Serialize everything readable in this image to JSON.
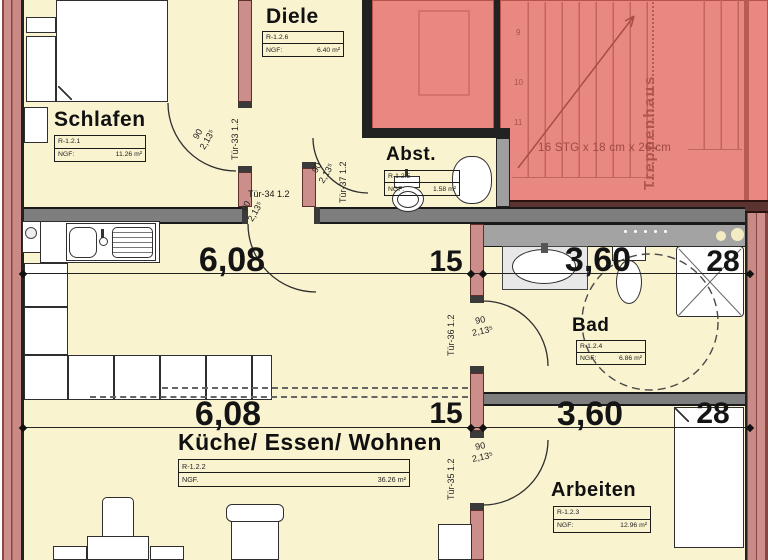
{
  "plan": {
    "rooms": {
      "schlafen": {
        "name": "Schlafen",
        "id": "R-1.2.1",
        "ngf": "NGF:",
        "area": "11.26 m²"
      },
      "diele": {
        "name": "Diele",
        "id": "R-1.2.6",
        "ngf": "NGF:",
        "area": "6.40 m²"
      },
      "abst": {
        "name": "Abst.",
        "id": "R-1.2.5",
        "ngf": "NGF:",
        "area": "1.58 m²"
      },
      "bad": {
        "name": "Bad",
        "id": "R-1.2.4",
        "ngf": "NGF:",
        "area": "6.86 m²"
      },
      "kueche": {
        "name": "Küche/ Essen/ Wohnen",
        "id": "R-1.2.2",
        "ngf": "NGF.",
        "area": "36.26 m²"
      },
      "arbeiten": {
        "name": "Arbeiten",
        "id": "R-1.2.3",
        "ngf": "NGF:",
        "area": "12.96 m²"
      }
    },
    "doors": {
      "t33": {
        "label": "Tür-33 1.2",
        "w": "90",
        "h": "2,13⁵"
      },
      "t34": {
        "label": "Tür-34 1.2",
        "w": "90",
        "h": "2,13⁵"
      },
      "t35": {
        "label": "Tür-35 1.2",
        "w": "90",
        "h": "2,13⁵"
      },
      "t36": {
        "label": "Tür-36 1.2",
        "w": "90",
        "h": "2,13⁵"
      },
      "t37": {
        "label": "Tür-37 1.2",
        "w": "90",
        "h": "2,13⁵"
      }
    },
    "dimensions": {
      "row1": {
        "a": "6,08",
        "b": "15",
        "c": "3,60",
        "d": "28"
      },
      "row2": {
        "a": "6,08",
        "b": "15",
        "c": "3,60",
        "d": "28"
      }
    },
    "stairs": {
      "name": "Treppenhaus",
      "spec": "16 STG x 18 cm x 26 cm",
      "steps": {
        "s9": "9",
        "s10": "10",
        "s11": "11"
      }
    },
    "colors": {
      "floor": "#f9f3d0",
      "wall_pink": "#cb8e8a",
      "stair_red": "#e98880",
      "wall_gray": "#7e7e7e",
      "line": "#222222"
    }
  }
}
